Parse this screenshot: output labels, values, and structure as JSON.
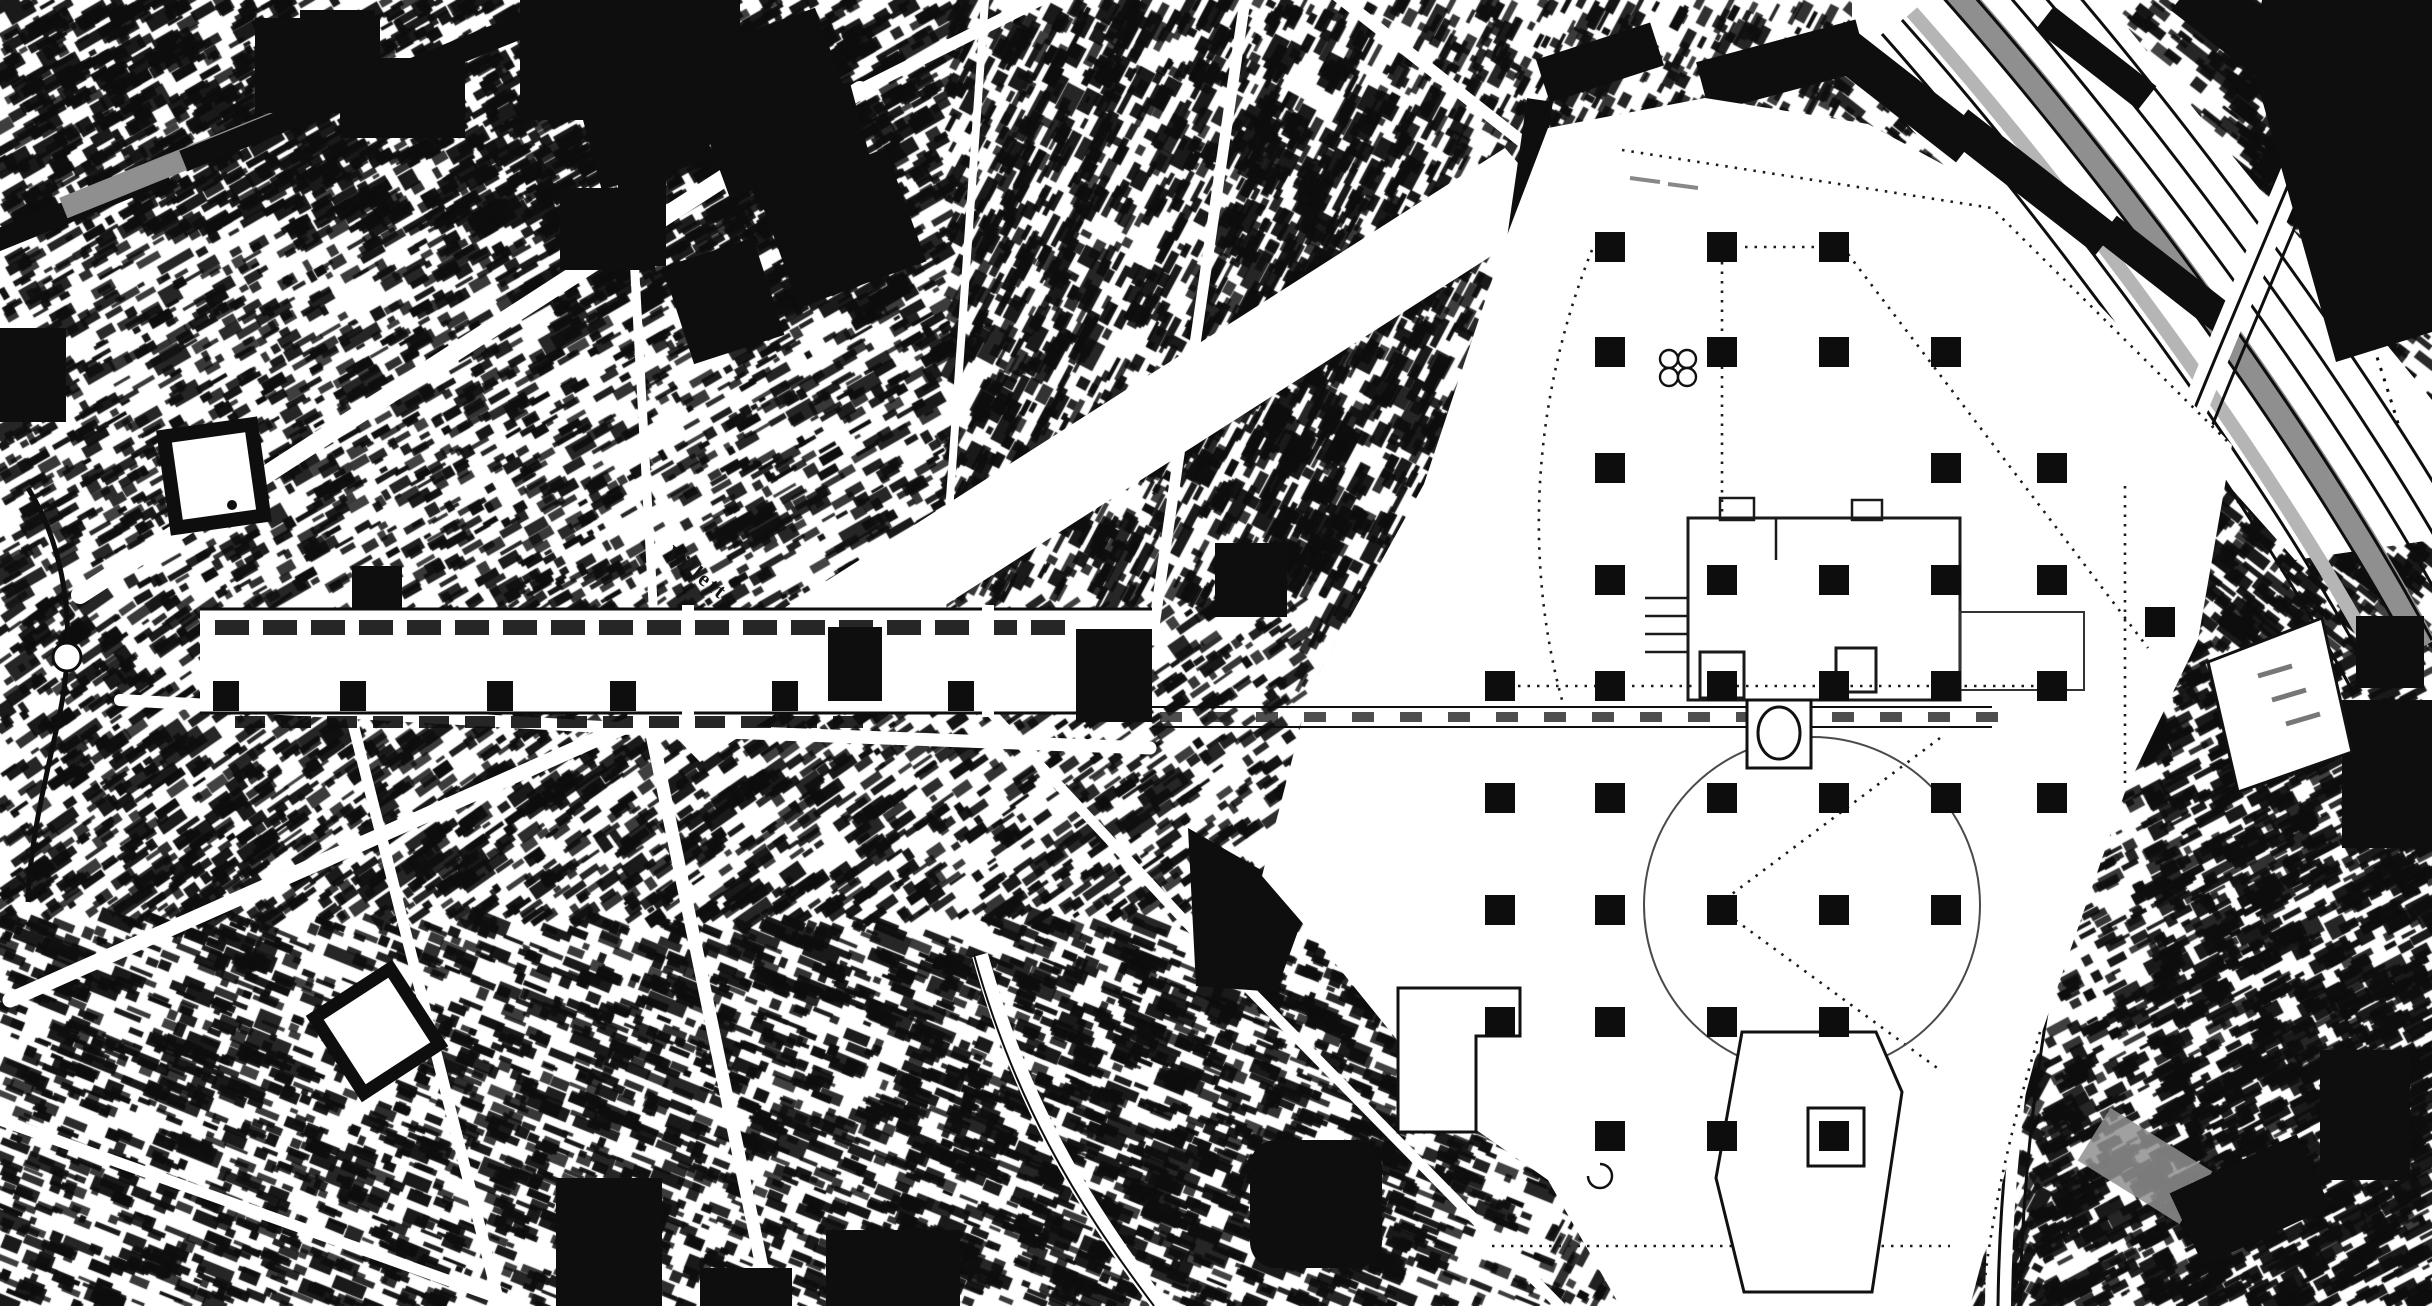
{
  "map": {
    "description": "Black-and-white figure-ground city map of the La Villette district, Paris: dense urban fabric, Bassin/Canal de l'Ourcq, railway yards, ring road and the Parc de la Villette grid of folly squares",
    "colors": {
      "ink": "#0e0e0e",
      "paper": "#ffffff",
      "gray": "#8f8f8f",
      "light_gray": "#b5b5b5"
    },
    "labels": [
      {
        "text": "Villette",
        "x": 664,
        "y": 556,
        "rot": 38,
        "size": 22
      }
    ],
    "park": {
      "polygon": [
        [
          1548,
          128
        ],
        [
          1705,
          98
        ],
        [
          1868,
          124
        ],
        [
          1990,
          190
        ],
        [
          2232,
          445
        ],
        [
          2198,
          640
        ],
        [
          2125,
          792
        ],
        [
          2042,
          1032
        ],
        [
          1970,
          1306
        ],
        [
          1620,
          1306
        ],
        [
          1548,
          1180
        ],
        [
          1462,
          1120
        ],
        [
          1300,
          920
        ],
        [
          1262,
          876
        ],
        [
          1310,
          690
        ],
        [
          1424,
          484
        ],
        [
          1506,
          238
        ]
      ],
      "follies": {
        "size": 30,
        "cols": [
          1500,
          1610,
          1722,
          1834,
          1946,
          2052
        ],
        "rows": [
          247,
          352,
          468,
          580,
          686,
          798,
          910,
          1022,
          1136
        ],
        "grid": [
          [
            1,
            2,
            3
          ],
          [
            1,
            2,
            3,
            4
          ],
          [
            1,
            4,
            5
          ],
          [
            1,
            2,
            3,
            4,
            5
          ],
          [
            0,
            1,
            2,
            3,
            4,
            5
          ],
          [
            0,
            1,
            2,
            3,
            4,
            5
          ],
          [
            0,
            1,
            2,
            3,
            4
          ],
          [
            0,
            1,
            2,
            3
          ],
          [
            1,
            2,
            3
          ]
        ],
        "extra": [
          [
            2160,
            622
          ]
        ]
      },
      "canal_crossing": {
        "x1": 1152,
        "x2": 1992,
        "y1": 707,
        "y2": 727
      }
    },
    "canal": {
      "x": 200,
      "x2": 1152,
      "y": 609,
      "y2": 713,
      "top_dashes": {
        "y": 620,
        "h": 15,
        "from": 215,
        "to": 1065,
        "w": 34,
        "gap": 14
      },
      "bottom_dashes": {
        "y": 716,
        "h": 12,
        "from": 235,
        "to": 860,
        "w": 30,
        "gap": 16
      },
      "squares": {
        "y": 681,
        "w": 26,
        "h": 30,
        "xs": [
          213,
          340,
          487,
          610,
          772,
          948
        ]
      },
      "east_blocks": [
        [
          828,
          627,
          54,
          74
        ],
        [
          1076,
          629,
          76,
          93
        ]
      ],
      "bridges": [
        682,
        982
      ]
    }
  }
}
